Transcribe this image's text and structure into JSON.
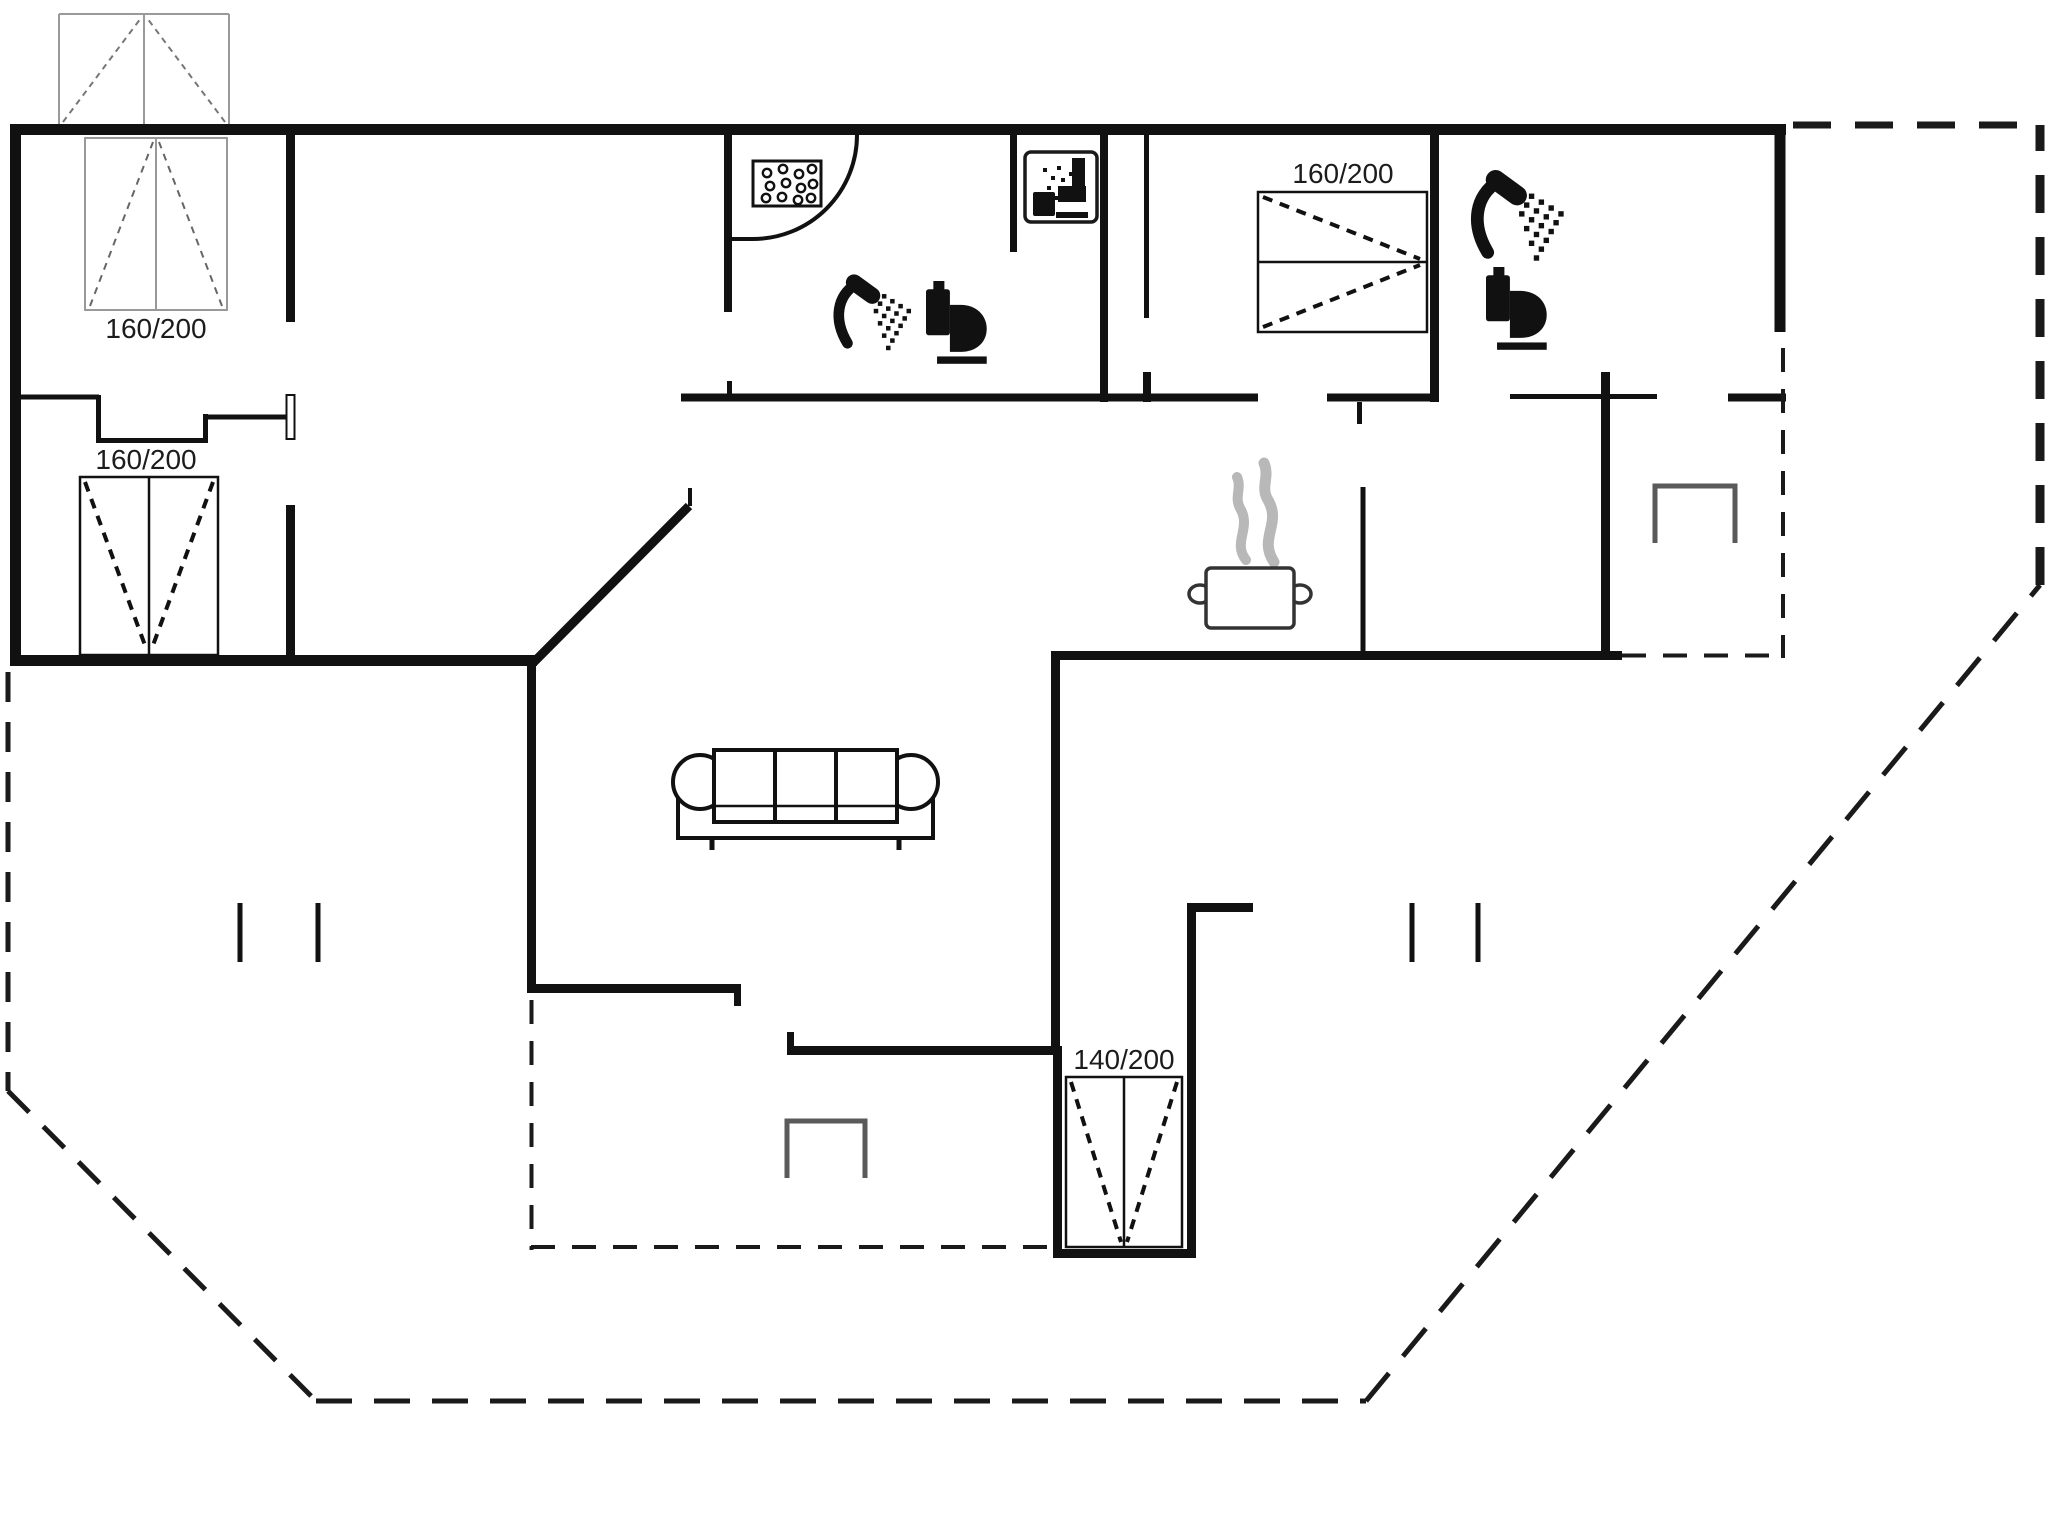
{
  "diagram": {
    "type": "holiday-house-floor-plan",
    "beds": [
      {
        "id": "bed-top-left",
        "size": "160/200"
      },
      {
        "id": "bed-mid-left",
        "size": "160/200"
      },
      {
        "id": "bed-top-right",
        "size": "160/200"
      },
      {
        "id": "bed-bottom-center",
        "size": "140/200"
      }
    ],
    "fixtures": {
      "bathroom_main": [
        "shower-cabin",
        "washbasin-tray",
        "shower-head",
        "toilet"
      ],
      "wc_room": [
        "bathroom-pictogram"
      ],
      "bathroom_second": [
        "shower-head",
        "toilet"
      ],
      "kitchen": [
        "cooking-pot-with-steam"
      ],
      "living_room": [
        "sofa"
      ],
      "terrace": [
        "dining-table",
        "dining-table",
        "post-markers"
      ]
    },
    "colors": {
      "walls": "#111111",
      "thin_lines": "#999999",
      "furniture_gray": "#5a5a5a",
      "steam_gray": "#b8b8b8",
      "background": "#ffffff"
    }
  }
}
